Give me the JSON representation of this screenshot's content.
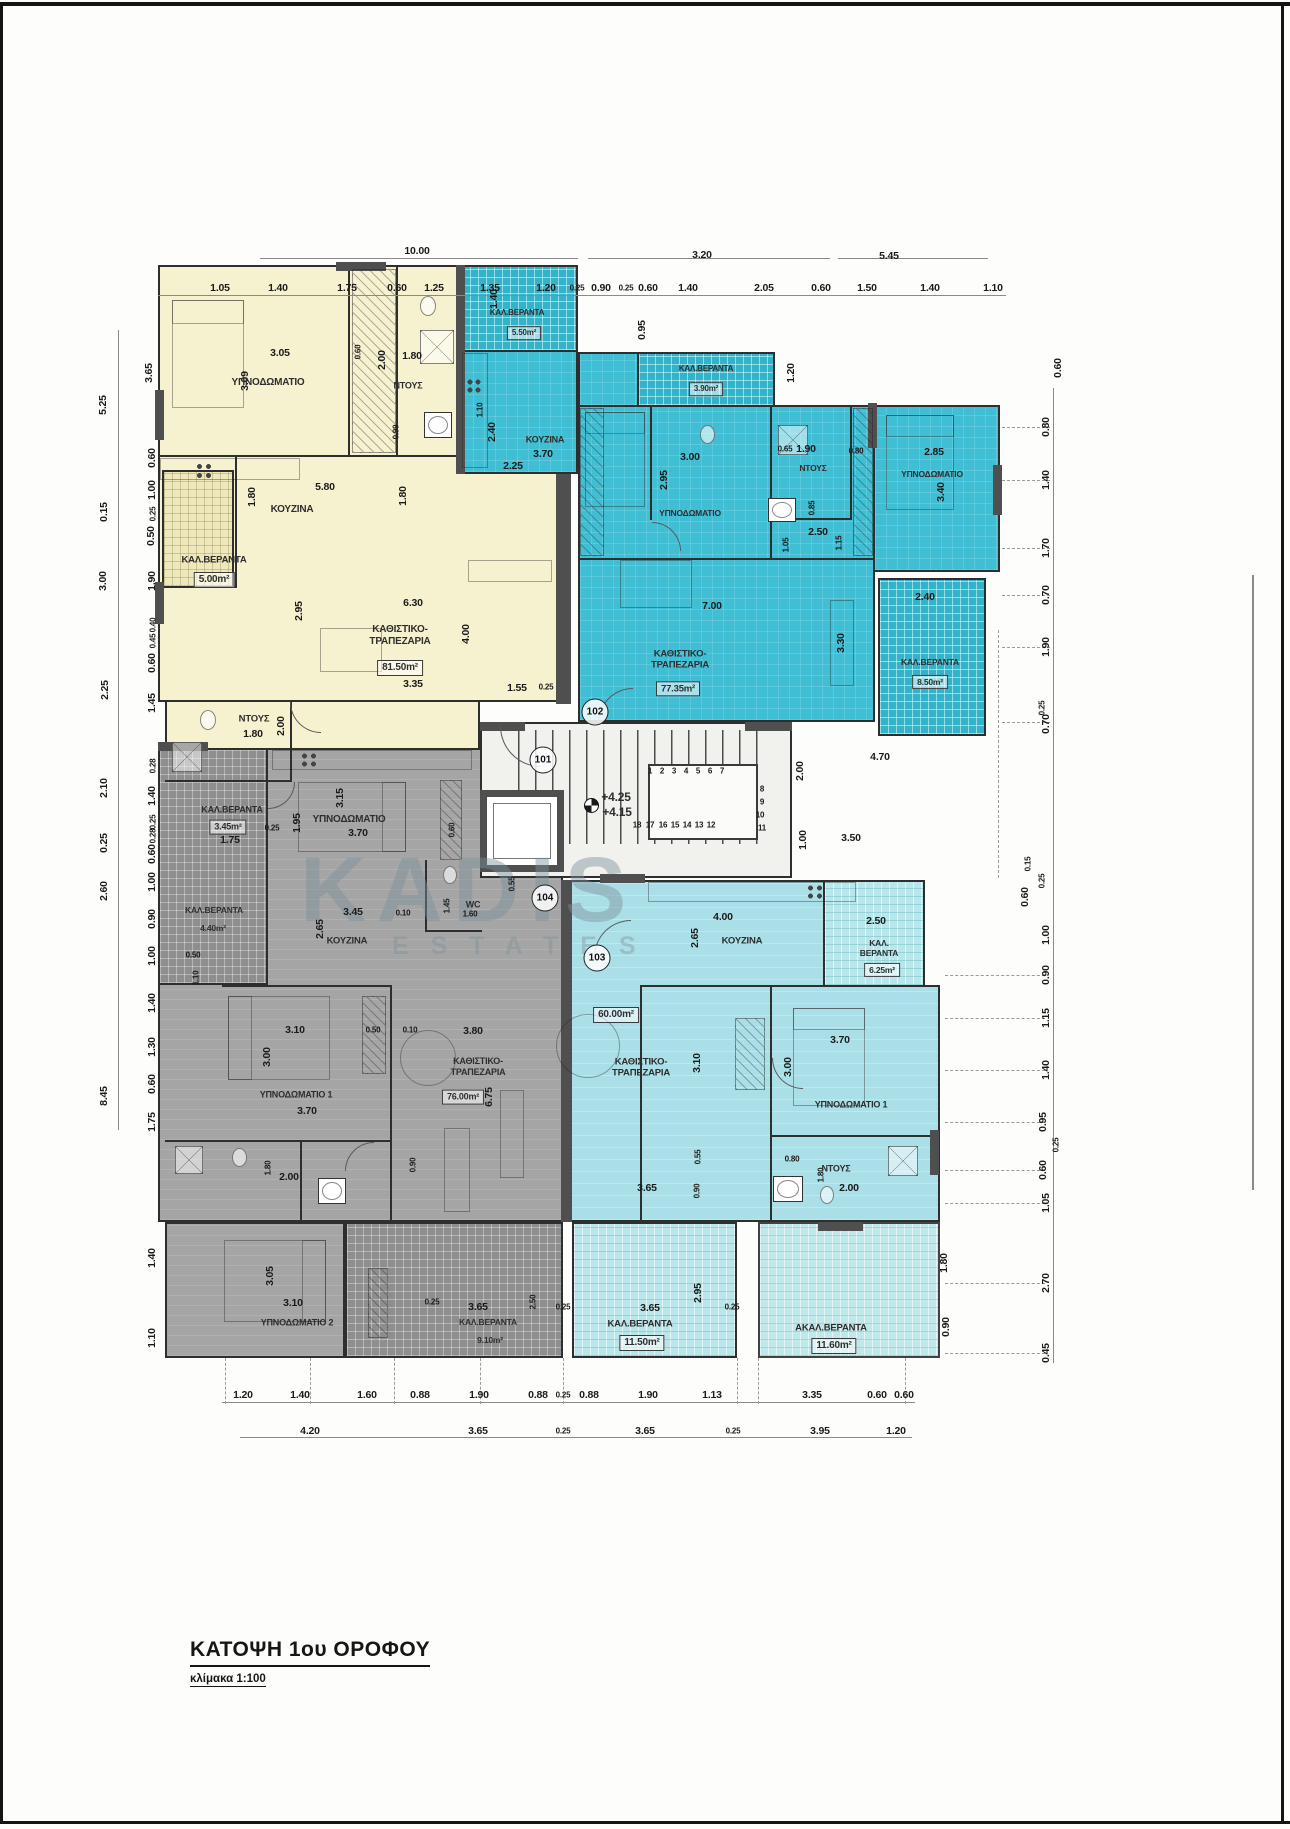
{
  "page": {
    "title": "ΚΑΤΟΨΗ 1ου ΟΡΟΦΟΥ",
    "scale_label": "κλίμακα 1:100"
  },
  "watermark": {
    "line1": "KADIS",
    "line2": "ESTATES"
  },
  "colors": {
    "apt101": "#f6f2d0",
    "apt102": "#3fbed4",
    "apt103": "#abdfe8",
    "apt104": "#a5a5a5",
    "balcony_cyan": "#b9e6ea",
    "wall": "#2e2e2e",
    "dim_text": "#1b1b1b",
    "watermark": "#7d919b"
  },
  "unit_badges": [
    {
      "n": "101",
      "x": 543,
      "y": 760
    },
    {
      "n": "102",
      "x": 595,
      "y": 712
    },
    {
      "n": "103",
      "x": 597,
      "y": 958
    },
    {
      "n": "104",
      "x": 545,
      "y": 898
    }
  ],
  "room_labels": [
    {
      "t": "ΥΠΝΟΔΩΜΑΤΙΟ",
      "x": 268,
      "y": 383
    },
    {
      "t": "ΝΤΟΥΣ",
      "x": 408,
      "y": 386,
      "f": 9
    },
    {
      "t": "ΚΟΥΖΙΝΑ",
      "x": 292,
      "y": 510
    },
    {
      "t": "ΚΑΛ.ΒΕΡΑΝΤΑ",
      "x": 214,
      "y": 560,
      "f": 9.5
    },
    {
      "t": "5.00m²",
      "x": 214,
      "y": 580,
      "b": 1
    },
    {
      "t": "ΚΑΘΙΣΤΙΚΟ-\nΤΡΑΠΕΖΑΡΙΑ",
      "x": 400,
      "y": 636
    },
    {
      "t": "81.50m²",
      "x": 400,
      "y": 668,
      "b": 1
    },
    {
      "t": "ΝΤΟΥΣ",
      "x": 254,
      "y": 719,
      "f": 9.5
    },
    {
      "t": "ΚΑΛ.ΒΕΡΑΝΤΑ",
      "x": 232,
      "y": 810,
      "f": 9
    },
    {
      "t": "3.45m²",
      "x": 228,
      "y": 827,
      "b": 1,
      "f": 9
    },
    {
      "t": "ΥΠΝΟΔΩΜΑΤΙΟ",
      "x": 349,
      "y": 820
    },
    {
      "t": "ΚΑΛ.ΒΕΡΑΝΤΑ",
      "x": 517,
      "y": 313,
      "f": 8
    },
    {
      "t": "5.50m²",
      "x": 524,
      "y": 333,
      "f": 8,
      "b": 1
    },
    {
      "t": "ΚΟΥΖΙΝΑ",
      "x": 545,
      "y": 440,
      "f": 9
    },
    {
      "t": "ΚΑΛ.ΒΕΡΑΝΤΑ",
      "x": 706,
      "y": 369,
      "f": 8
    },
    {
      "t": "3.90m²",
      "x": 706,
      "y": 389,
      "f": 8,
      "b": 1
    },
    {
      "t": "ΥΠΝΟΔΩΜΑΤΙΟ",
      "x": 690,
      "y": 513,
      "f": 8.5
    },
    {
      "t": "ΝΤΟΥΣ",
      "x": 813,
      "y": 468,
      "f": 8.5
    },
    {
      "t": "ΥΠΝΟΔΩΜΑΤΙΟ",
      "x": 932,
      "y": 474,
      "f": 8.5
    },
    {
      "t": "ΚΑΘΙΣΤΙΚΟ-\nΤΡΑΠΕΖΑΡΙΑ",
      "x": 680,
      "y": 660,
      "f": 9.5
    },
    {
      "t": "77.35m²",
      "x": 678,
      "y": 689,
      "b": 1,
      "f": 9.5
    },
    {
      "t": "ΚΑΛ.ΒΕΡΑΝΤΑ",
      "x": 930,
      "y": 662,
      "f": 8.5
    },
    {
      "t": "8.50m²",
      "x": 930,
      "y": 682,
      "b": 1,
      "f": 8.5
    },
    {
      "t": "+4.25",
      "x": 616,
      "y": 797,
      "f": 12
    },
    {
      "t": "+4.15",
      "x": 617,
      "y": 812,
      "f": 12
    },
    {
      "t": "ΚΟΥΖΙΝΑ",
      "x": 742,
      "y": 941,
      "f": 9.5
    },
    {
      "t": "60.00m²",
      "x": 616,
      "y": 1015,
      "b": 1
    },
    {
      "t": "ΚΑΘΙΣΤΙΚΟ-\nΤΡΑΠΕΖΑΡΙΑ",
      "x": 641,
      "y": 1068,
      "f": 9.5
    },
    {
      "t": "ΥΠΝΟΔΩΜΑΤΙΟ 1",
      "x": 851,
      "y": 1105,
      "f": 9
    },
    {
      "t": "ΝΤΟΥΣ",
      "x": 836,
      "y": 1169,
      "f": 9
    },
    {
      "t": "ΚΑΛ.\nΒΕΡΑΝΤΑ",
      "x": 879,
      "y": 948,
      "f": 8.5
    },
    {
      "t": "6.25m²",
      "x": 882,
      "y": 970,
      "b": 1,
      "f": 8.5
    },
    {
      "t": "ΚΑΛ.ΒΕΡΑΝΤΑ",
      "x": 640,
      "y": 1324,
      "f": 9.5
    },
    {
      "t": "11.50m²",
      "x": 642,
      "y": 1343,
      "b": 1
    },
    {
      "t": "ΑΚΑΛ.ΒΕΡΑΝΤΑ",
      "x": 831,
      "y": 1328,
      "f": 9.5
    },
    {
      "t": "11.60m²",
      "x": 834,
      "y": 1346,
      "b": 1
    },
    {
      "t": "ΚΑΛ.ΒΕΡΑΝΤΑ",
      "x": 214,
      "y": 910,
      "f": 8.5
    },
    {
      "t": "4.40m²",
      "x": 213,
      "y": 928,
      "f": 8.5
    },
    {
      "t": "ΚΟΥΖΙΝΑ",
      "x": 347,
      "y": 941,
      "f": 9.5
    },
    {
      "t": "WC",
      "x": 473,
      "y": 905,
      "f": 9
    },
    {
      "t": "ΚΑΘΙΣΤΙΚΟ-\nΤΡΑΠΕΖΑΡΙΑ",
      "x": 478,
      "y": 1067,
      "f": 9
    },
    {
      "t": "76.00m²",
      "x": 463,
      "y": 1097,
      "b": 1,
      "f": 9
    },
    {
      "t": "ΥΠΝΟΔΩΜΑΤΙΟ 1",
      "x": 296,
      "y": 1095,
      "f": 9
    },
    {
      "t": "ΥΠΝΟΔΩΜΑΤΙΟ 2",
      "x": 297,
      "y": 1323,
      "f": 9
    },
    {
      "t": "ΚΑΛ.ΒΕΡΑΝΤΑ",
      "x": 488,
      "y": 1322,
      "f": 8.5
    },
    {
      "t": "9.10m²",
      "x": 490,
      "y": 1340,
      "f": 8.5
    }
  ],
  "dims": [
    {
      "t": "10.00",
      "x": 417,
      "y": 251
    },
    {
      "t": "3.20",
      "x": 702,
      "y": 255
    },
    {
      "t": "5.45",
      "x": 889,
      "y": 256
    },
    {
      "t": "1.05",
      "x": 220,
      "y": 288
    },
    {
      "t": "1.40",
      "x": 278,
      "y": 288
    },
    {
      "t": "1.75",
      "x": 347,
      "y": 288
    },
    {
      "t": "0.60",
      "x": 397,
      "y": 288
    },
    {
      "t": "1.25",
      "x": 434,
      "y": 288
    },
    {
      "t": "1.35",
      "x": 490,
      "y": 288
    },
    {
      "t": "1.20",
      "x": 546,
      "y": 288
    },
    {
      "t": "0.25",
      "x": 577,
      "y": 288,
      "s": 1
    },
    {
      "t": "0.90",
      "x": 601,
      "y": 288
    },
    {
      "t": "0.25",
      "x": 626,
      "y": 288,
      "s": 1
    },
    {
      "t": "0.60",
      "x": 648,
      "y": 288
    },
    {
      "t": "1.40",
      "x": 688,
      "y": 288
    },
    {
      "t": "2.05",
      "x": 764,
      "y": 288
    },
    {
      "t": "0.60",
      "x": 821,
      "y": 288
    },
    {
      "t": "1.50",
      "x": 867,
      "y": 288
    },
    {
      "t": "1.40",
      "x": 930,
      "y": 288
    },
    {
      "t": "1.10",
      "x": 993,
      "y": 288
    },
    {
      "t": "5.25",
      "x": 103,
      "y": 405,
      "r": 1
    },
    {
      "t": "0.15",
      "x": 104,
      "y": 512,
      "r": 1
    },
    {
      "t": "3.00",
      "x": 103,
      "y": 581,
      "r": 1
    },
    {
      "t": "2.25",
      "x": 105,
      "y": 690,
      "r": 1
    },
    {
      "t": "2.10",
      "x": 104,
      "y": 788,
      "r": 1
    },
    {
      "t": "0.25",
      "x": 104,
      "y": 843,
      "r": 1
    },
    {
      "t": "2.60",
      "x": 104,
      "y": 891,
      "r": 1
    },
    {
      "t": "8.45",
      "x": 104,
      "y": 1096,
      "r": 1
    },
    {
      "t": "3.65",
      "x": 149,
      "y": 373,
      "r": 1
    },
    {
      "t": "0.60",
      "x": 152,
      "y": 458,
      "r": 1
    },
    {
      "t": "1.00",
      "x": 152,
      "y": 490,
      "r": 1
    },
    {
      "t": "0.25",
      "x": 153,
      "y": 514,
      "r": 1,
      "s": 1
    },
    {
      "t": "0.50",
      "x": 151,
      "y": 536,
      "r": 1
    },
    {
      "t": "1.90",
      "x": 152,
      "y": 581,
      "r": 1
    },
    {
      "t": "0.40",
      "x": 153,
      "y": 625,
      "r": 1,
      "s": 1
    },
    {
      "t": "0.45",
      "x": 153,
      "y": 641,
      "r": 1,
      "s": 1
    },
    {
      "t": "0.60",
      "x": 152,
      "y": 663,
      "r": 1
    },
    {
      "t": "1.45",
      "x": 152,
      "y": 703,
      "r": 1
    },
    {
      "t": "0.28",
      "x": 153,
      "y": 766,
      "r": 1,
      "s": 1
    },
    {
      "t": "1.40",
      "x": 152,
      "y": 796,
      "r": 1
    },
    {
      "t": "0.25",
      "x": 153,
      "y": 822,
      "r": 1,
      "s": 1
    },
    {
      "t": "0.28",
      "x": 153,
      "y": 836,
      "r": 1,
      "s": 1
    },
    {
      "t": "0.60",
      "x": 152,
      "y": 854,
      "r": 1
    },
    {
      "t": "1.00",
      "x": 152,
      "y": 882,
      "r": 1
    },
    {
      "t": "0.90",
      "x": 152,
      "y": 919,
      "r": 1
    },
    {
      "t": "1.00",
      "x": 152,
      "y": 956,
      "r": 1
    },
    {
      "t": "1.40",
      "x": 152,
      "y": 1003,
      "r": 1
    },
    {
      "t": "1.30",
      "x": 152,
      "y": 1047,
      "r": 1
    },
    {
      "t": "0.60",
      "x": 152,
      "y": 1084,
      "r": 1
    },
    {
      "t": "1.75",
      "x": 152,
      "y": 1122,
      "r": 1
    },
    {
      "t": "1.40",
      "x": 152,
      "y": 1258,
      "r": 1
    },
    {
      "t": "1.10",
      "x": 152,
      "y": 1338,
      "r": 1
    },
    {
      "t": "0.60",
      "x": 1058,
      "y": 368,
      "r": 1
    },
    {
      "t": "0.80",
      "x": 1046,
      "y": 427,
      "r": 1
    },
    {
      "t": "1.40",
      "x": 1046,
      "y": 480,
      "r": 1
    },
    {
      "t": "1.70",
      "x": 1046,
      "y": 548,
      "r": 1
    },
    {
      "t": "0.70",
      "x": 1046,
      "y": 595,
      "r": 1
    },
    {
      "t": "1.90",
      "x": 1046,
      "y": 647,
      "r": 1
    },
    {
      "t": "0.25",
      "x": 1042,
      "y": 708,
      "r": 1,
      "s": 1
    },
    {
      "t": "0.70",
      "x": 1046,
      "y": 724,
      "r": 1
    },
    {
      "t": "0.15",
      "x": 1028,
      "y": 864,
      "r": 1,
      "s": 1
    },
    {
      "t": "0.25",
      "x": 1042,
      "y": 881,
      "r": 1,
      "s": 1
    },
    {
      "t": "0.60",
      "x": 1025,
      "y": 897,
      "r": 1
    },
    {
      "t": "1.00",
      "x": 1046,
      "y": 935,
      "r": 1
    },
    {
      "t": "0.90",
      "x": 1046,
      "y": 975,
      "r": 1
    },
    {
      "t": "1.15",
      "x": 1046,
      "y": 1018,
      "r": 1
    },
    {
      "t": "1.40",
      "x": 1046,
      "y": 1070,
      "r": 1
    },
    {
      "t": "0.95",
      "x": 1043,
      "y": 1122,
      "r": 1
    },
    {
      "t": "0.25",
      "x": 1056,
      "y": 1145,
      "r": 1,
      "s": 1
    },
    {
      "t": "0.60",
      "x": 1043,
      "y": 1170,
      "r": 1
    },
    {
      "t": "1.05",
      "x": 1046,
      "y": 1203,
      "r": 1
    },
    {
      "t": "2.70",
      "x": 1046,
      "y": 1283,
      "r": 1
    },
    {
      "t": "0.45",
      "x": 1046,
      "y": 1353,
      "r": 1
    },
    {
      "t": "4.70",
      "x": 880,
      "y": 757
    },
    {
      "t": "3.50",
      "x": 851,
      "y": 838
    },
    {
      "t": "2.00",
      "x": 800,
      "y": 771,
      "r": 1
    },
    {
      "t": "1.00",
      "x": 803,
      "y": 840,
      "r": 1
    },
    {
      "t": "1.80",
      "x": 944,
      "y": 1263,
      "r": 1
    },
    {
      "t": "0.90",
      "x": 946,
      "y": 1327,
      "r": 1
    },
    {
      "t": "1.20",
      "x": 243,
      "y": 1395
    },
    {
      "t": "1.40",
      "x": 300,
      "y": 1395
    },
    {
      "t": "1.60",
      "x": 367,
      "y": 1395
    },
    {
      "t": "0.88",
      "x": 420,
      "y": 1395
    },
    {
      "t": "1.90",
      "x": 479,
      "y": 1395
    },
    {
      "t": "0.88",
      "x": 538,
      "y": 1395
    },
    {
      "t": "0.25",
      "x": 563,
      "y": 1395,
      "s": 1
    },
    {
      "t": "0.88",
      "x": 589,
      "y": 1395
    },
    {
      "t": "1.90",
      "x": 648,
      "y": 1395
    },
    {
      "t": "1.13",
      "x": 712,
      "y": 1395
    },
    {
      "t": "3.35",
      "x": 812,
      "y": 1395
    },
    {
      "t": "0.60",
      "x": 877,
      "y": 1395
    },
    {
      "t": "0.60",
      "x": 904,
      "y": 1395
    },
    {
      "t": "4.20",
      "x": 310,
      "y": 1431
    },
    {
      "t": "3.65",
      "x": 478,
      "y": 1431
    },
    {
      "t": "0.25",
      "x": 563,
      "y": 1431,
      "s": 1
    },
    {
      "t": "3.65",
      "x": 645,
      "y": 1431
    },
    {
      "t": "0.25",
      "x": 733,
      "y": 1431,
      "s": 1
    },
    {
      "t": "3.95",
      "x": 820,
      "y": 1431
    },
    {
      "t": "1.20",
      "x": 896,
      "y": 1431
    },
    {
      "t": "3.05",
      "x": 280,
      "y": 353
    },
    {
      "t": "3.09",
      "x": 245,
      "y": 381,
      "r": 1
    },
    {
      "t": "0.60",
      "x": 358,
      "y": 352,
      "r": 1,
      "s": 1
    },
    {
      "t": "2.00",
      "x": 382,
      "y": 360,
      "r": 1
    },
    {
      "t": "1.80",
      "x": 412,
      "y": 356
    },
    {
      "t": "0.99",
      "x": 396,
      "y": 432,
      "r": 1,
      "s": 1
    },
    {
      "t": "5.80",
      "x": 325,
      "y": 487
    },
    {
      "t": "1.80",
      "x": 252,
      "y": 497,
      "r": 1
    },
    {
      "t": "1.80",
      "x": 403,
      "y": 496,
      "r": 1
    },
    {
      "t": "2.95",
      "x": 299,
      "y": 611,
      "r": 1
    },
    {
      "t": "6.30",
      "x": 413,
      "y": 603
    },
    {
      "t": "4.00",
      "x": 466,
      "y": 634,
      "r": 1
    },
    {
      "t": "3.35",
      "x": 413,
      "y": 684
    },
    {
      "t": "1.55",
      "x": 517,
      "y": 688
    },
    {
      "t": "0.25",
      "x": 546,
      "y": 687,
      "s": 1
    },
    {
      "t": "1.80",
      "x": 253,
      "y": 734
    },
    {
      "t": "2.00",
      "x": 281,
      "y": 726,
      "r": 1
    },
    {
      "t": "3.15",
      "x": 340,
      "y": 798,
      "r": 1
    },
    {
      "t": "1.95",
      "x": 297,
      "y": 823,
      "r": 1
    },
    {
      "t": "0.25",
      "x": 272,
      "y": 828,
      "s": 1
    },
    {
      "t": "3.70",
      "x": 358,
      "y": 833
    },
    {
      "t": "1.75",
      "x": 230,
      "y": 840
    },
    {
      "t": "0.60",
      "x": 452,
      "y": 830,
      "r": 1,
      "s": 1
    },
    {
      "t": "1.40",
      "x": 494,
      "y": 299,
      "r": 1
    },
    {
      "t": "2.40",
      "x": 492,
      "y": 432,
      "r": 1
    },
    {
      "t": "3.70",
      "x": 543,
      "y": 454
    },
    {
      "t": "1.10",
      "x": 480,
      "y": 410,
      "r": 1,
      "s": 1
    },
    {
      "t": "2.25",
      "x": 513,
      "y": 466
    },
    {
      "t": "0.95",
      "x": 642,
      "y": 330,
      "r": 1
    },
    {
      "t": "1.20",
      "x": 791,
      "y": 373,
      "r": 1
    },
    {
      "t": "3.00",
      "x": 690,
      "y": 457
    },
    {
      "t": "2.95",
      "x": 664,
      "y": 480,
      "r": 1
    },
    {
      "t": "0.65",
      "x": 785,
      "y": 449,
      "s": 1
    },
    {
      "t": "1.90",
      "x": 806,
      "y": 449
    },
    {
      "t": "0.80",
      "x": 856,
      "y": 451,
      "s": 1
    },
    {
      "t": "0.85",
      "x": 812,
      "y": 508,
      "r": 1,
      "s": 1
    },
    {
      "t": "2.50",
      "x": 818,
      "y": 532
    },
    {
      "t": "1.05",
      "x": 786,
      "y": 545,
      "r": 1,
      "s": 1
    },
    {
      "t": "1.15",
      "x": 839,
      "y": 543,
      "r": 1,
      "s": 1
    },
    {
      "t": "2.85",
      "x": 934,
      "y": 452
    },
    {
      "t": "3.40",
      "x": 941,
      "y": 492,
      "r": 1
    },
    {
      "t": "7.00",
      "x": 712,
      "y": 606
    },
    {
      "t": "3.30",
      "x": 841,
      "y": 643,
      "r": 1
    },
    {
      "t": "2.40",
      "x": 925,
      "y": 597
    },
    {
      "t": "0.55",
      "x": 512,
      "y": 884,
      "r": 1,
      "s": 1
    },
    {
      "t": "4.00",
      "x": 723,
      "y": 917
    },
    {
      "t": "2.65",
      "x": 695,
      "y": 938,
      "r": 1
    },
    {
      "t": "3.10",
      "x": 697,
      "y": 1063,
      "r": 1
    },
    {
      "t": "3.00",
      "x": 788,
      "y": 1067,
      "r": 1
    },
    {
      "t": "3.70",
      "x": 840,
      "y": 1040
    },
    {
      "t": "3.65",
      "x": 647,
      "y": 1188
    },
    {
      "t": "0.55",
      "x": 698,
      "y": 1157,
      "r": 1,
      "s": 1
    },
    {
      "t": "0.90",
      "x": 697,
      "y": 1191,
      "r": 1,
      "s": 1
    },
    {
      "t": "0.80",
      "x": 792,
      "y": 1159,
      "s": 1
    },
    {
      "t": "1.80",
      "x": 821,
      "y": 1175,
      "r": 1,
      "s": 1
    },
    {
      "t": "2.00",
      "x": 849,
      "y": 1188
    },
    {
      "t": "2.95",
      "x": 698,
      "y": 1293,
      "r": 1
    },
    {
      "t": "0.25",
      "x": 732,
      "y": 1307,
      "s": 1
    },
    {
      "t": "3.65",
      "x": 650,
      "y": 1308
    },
    {
      "t": "2.50",
      "x": 876,
      "y": 921
    },
    {
      "t": "3.45",
      "x": 353,
      "y": 912
    },
    {
      "t": "0.10",
      "x": 403,
      "y": 913,
      "s": 1
    },
    {
      "t": "2.65",
      "x": 320,
      "y": 929,
      "r": 1
    },
    {
      "t": "1.45",
      "x": 447,
      "y": 906,
      "r": 1,
      "s": 1
    },
    {
      "t": "1.60",
      "x": 470,
      "y": 914,
      "s": 1
    },
    {
      "t": "1.10",
      "x": 196,
      "y": 978,
      "r": 1,
      "s": 1
    },
    {
      "t": "0.50",
      "x": 193,
      "y": 955,
      "s": 1
    },
    {
      "t": "3.10",
      "x": 295,
      "y": 1030
    },
    {
      "t": "3.00",
      "x": 267,
      "y": 1057,
      "r": 1
    },
    {
      "t": "0.50",
      "x": 373,
      "y": 1030,
      "s": 1
    },
    {
      "t": "0.10",
      "x": 410,
      "y": 1030,
      "s": 1
    },
    {
      "t": "3.80",
      "x": 473,
      "y": 1031
    },
    {
      "t": "6.75",
      "x": 489,
      "y": 1097,
      "r": 1
    },
    {
      "t": "3.70",
      "x": 307,
      "y": 1111
    },
    {
      "t": "2.00",
      "x": 289,
      "y": 1177
    },
    {
      "t": "1.80",
      "x": 268,
      "y": 1168,
      "r": 1,
      "s": 1
    },
    {
      "t": "0.90",
      "x": 413,
      "y": 1165,
      "r": 1,
      "s": 1
    },
    {
      "t": "3.05",
      "x": 270,
      "y": 1276,
      "r": 1
    },
    {
      "t": "3.10",
      "x": 293,
      "y": 1303
    },
    {
      "t": "3.65",
      "x": 478,
      "y": 1307
    },
    {
      "t": "2.50",
      "x": 533,
      "y": 1302,
      "r": 1,
      "s": 1
    },
    {
      "t": "0.25",
      "x": 563,
      "y": 1307,
      "s": 1
    },
    {
      "t": "0.25",
      "x": 432,
      "y": 1302,
      "s": 1
    },
    {
      "t": "1",
      "x": 650,
      "y": 771,
      "s": 1
    },
    {
      "t": "2",
      "x": 662,
      "y": 771,
      "s": 1
    },
    {
      "t": "3",
      "x": 674,
      "y": 771,
      "s": 1
    },
    {
      "t": "4",
      "x": 686,
      "y": 771,
      "s": 1
    },
    {
      "t": "5",
      "x": 698,
      "y": 771,
      "s": 1
    },
    {
      "t": "6",
      "x": 710,
      "y": 771,
      "s": 1
    },
    {
      "t": "7",
      "x": 722,
      "y": 771,
      "s": 1
    },
    {
      "t": "8",
      "x": 762,
      "y": 789,
      "s": 1
    },
    {
      "t": "9",
      "x": 762,
      "y": 802,
      "s": 1
    },
    {
      "t": "10",
      "x": 760,
      "y": 815,
      "s": 1
    },
    {
      "t": "11",
      "x": 762,
      "y": 828,
      "s": 1
    },
    {
      "t": "18",
      "x": 637,
      "y": 825,
      "s": 1
    },
    {
      "t": "17",
      "x": 650,
      "y": 825,
      "s": 1
    },
    {
      "t": "16",
      "x": 663,
      "y": 825,
      "s": 1
    },
    {
      "t": "15",
      "x": 675,
      "y": 825,
      "s": 1
    },
    {
      "t": "14",
      "x": 687,
      "y": 825,
      "s": 1
    },
    {
      "t": "13",
      "x": 699,
      "y": 825,
      "s": 1
    },
    {
      "t": "12",
      "x": 711,
      "y": 825,
      "s": 1
    }
  ]
}
